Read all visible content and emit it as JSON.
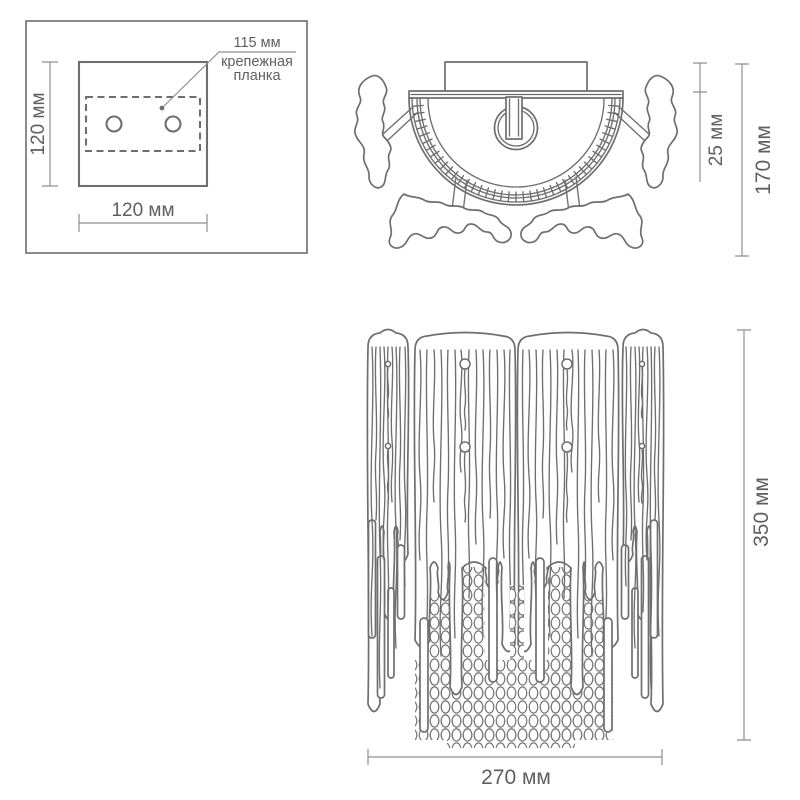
{
  "colors": {
    "background": "#ffffff",
    "drawing_line": "#6e6e6e",
    "dimension_line": "#8f8f8f",
    "text": "#5f5f5f"
  },
  "mounting_plate_view": {
    "plate_height_label": "120 мм",
    "plate_width_label": "120 мм",
    "hole_spacing_label": "115 мм",
    "bracket_label_line1": "крепежная",
    "bracket_label_line2": "планка"
  },
  "top_view": {
    "canopy_depth_label": "25 мм",
    "fixture_depth_label": "170 мм"
  },
  "front_view": {
    "fixture_height_label": "350 мм",
    "fixture_width_label": "270 мм"
  }
}
